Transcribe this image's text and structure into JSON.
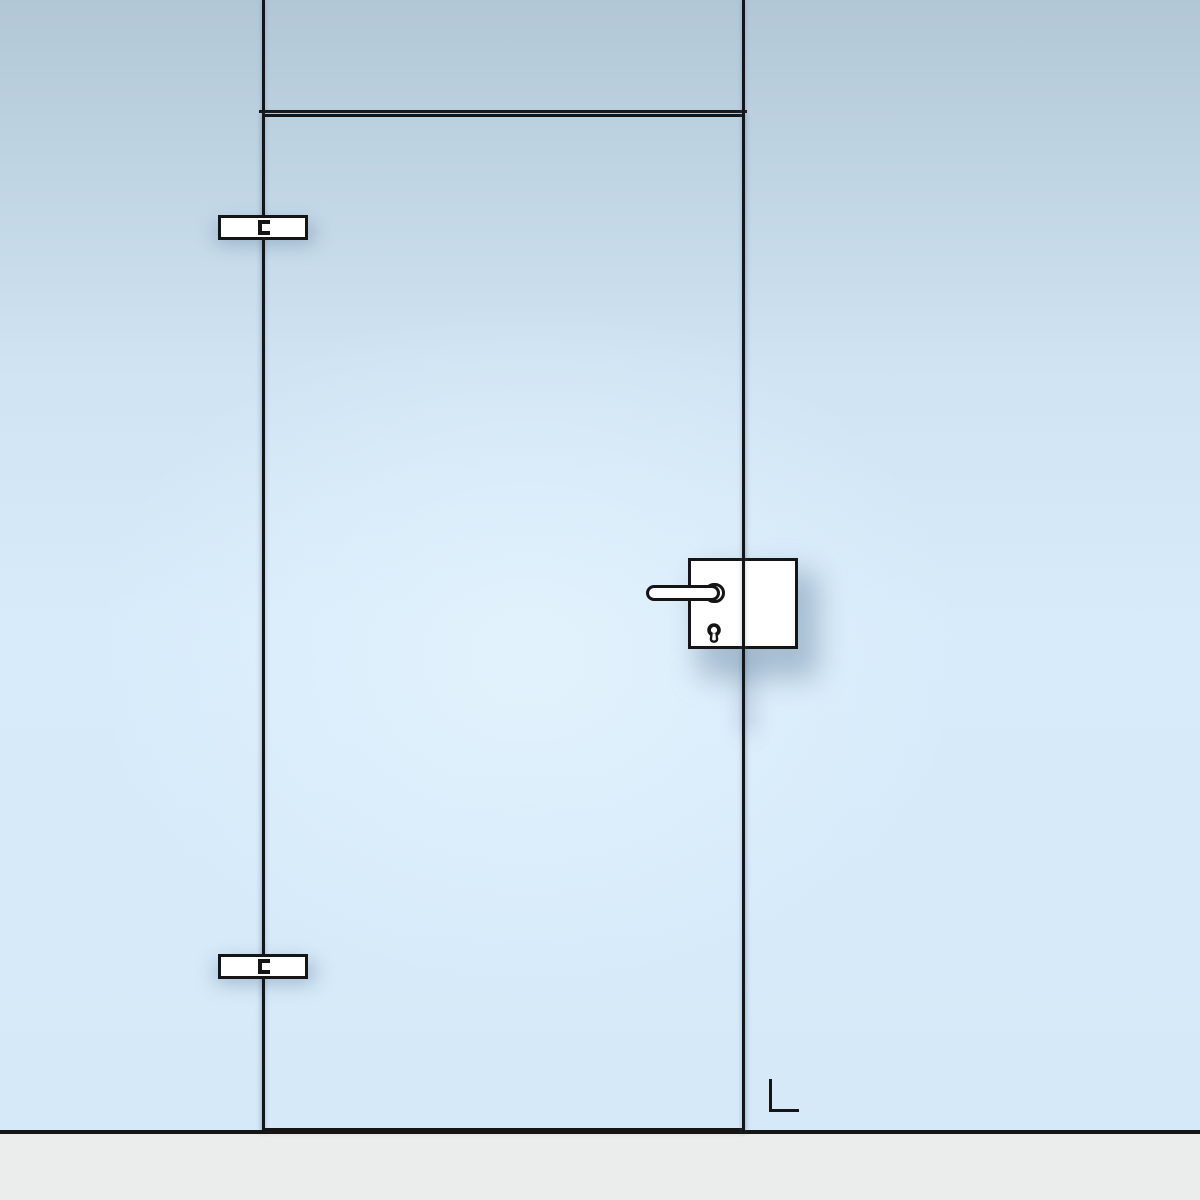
{
  "scene": {
    "name": "glass-door-front-view",
    "description_label": "Glass door leaf between glass side panels with transom, front view",
    "direction_indicator": "L",
    "hinge_count": 2,
    "hinge_side": "left",
    "handle_side": "right"
  },
  "icons": {
    "hinge": "hinge-icon",
    "handle": "lever-handle-icon",
    "keyhole": "keyhole-icon",
    "direction": "din-left-mark"
  },
  "colors": {
    "glass_top": "#b2c7d6",
    "glass_mid": "#cfe3f2",
    "glass_bottom": "#d7ebfa",
    "glass_highlight": "#e2f2fd",
    "outline": "#151515",
    "fitting_fill": "#ffffff",
    "floor": "#ebecec",
    "shadow": "rgba(124,150,174,0.55)"
  }
}
